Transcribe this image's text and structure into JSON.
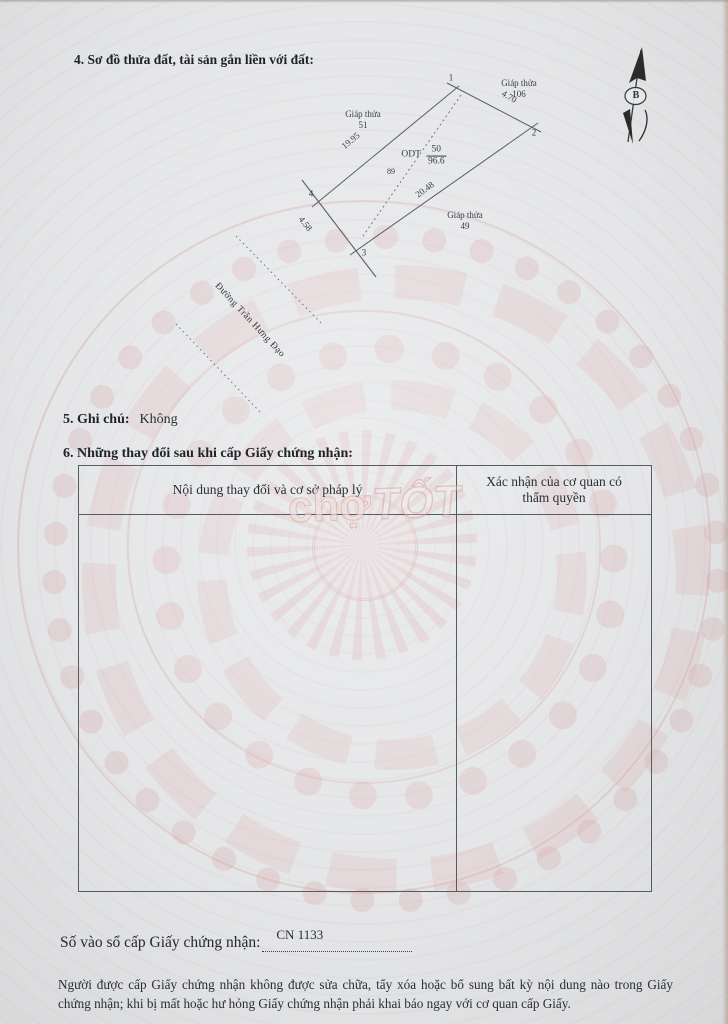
{
  "document": {
    "section4_heading": "4. Sơ đồ thửa đất, tài sản gắn liền với đất:",
    "section5_label": "5. Ghi chú:",
    "section5_value": "Không",
    "section6_heading": "6. Những thay đổi sau khi cấp Giấy chứng nhận:",
    "registry_label": "Số vào sổ cấp Giấy chứng nhận:",
    "registry_value": "CN 1133",
    "notice": "Người được cấp Giấy chứng nhận không được sửa chữa, tẩy xóa hoặc bổ sung bất kỳ nội dung nào trong Giấy chứng nhận; khi bị mất hoặc hư hỏng Giấy chứng nhận phải khai báo ngay với cơ quan cấp Giấy."
  },
  "diagram": {
    "north_marker": "B",
    "parcel": {
      "land_use_code": "ODT",
      "plot_number": "50",
      "area": "96.6",
      "house_number": "89",
      "vertex_labels": {
        "v1": "1",
        "v2": "2",
        "v3": "3",
        "v4": "4"
      },
      "edge_lengths": {
        "top_right": "4.70",
        "long_right": "20.48",
        "bottom_left": "4.58",
        "long_left": "19.95"
      }
    },
    "adjacent_plots": {
      "left": {
        "label": "Giáp thửa",
        "number": "51"
      },
      "top_right": {
        "label": "Giáp thửa",
        "number": "106"
      },
      "bottom_right": {
        "label": "Giáp thửa",
        "number": "49"
      }
    },
    "road_name": "Đường Trần Hưng Đạo"
  },
  "table": {
    "headers": {
      "changes": "Nội dung thay đổi và cơ sở pháp lý",
      "confirmation": "Xác nhận của cơ quan có thẩm quyền"
    }
  },
  "watermark": {
    "part1": "chợ",
    "part2": "TỐT"
  },
  "colors": {
    "paper": "#e4e6e8",
    "guilloche": "#dca8a8",
    "ink": "#2a2e33"
  }
}
